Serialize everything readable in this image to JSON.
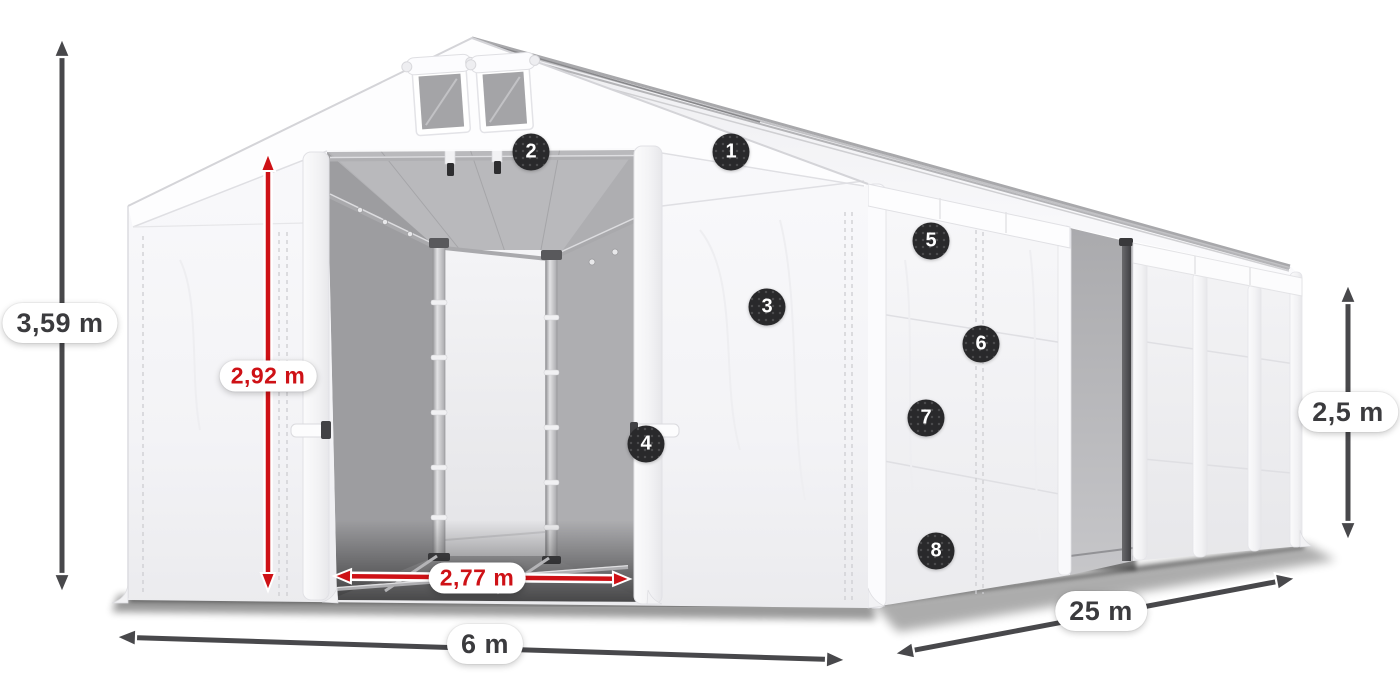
{
  "diagram": {
    "dimensions": {
      "total_height": "3,59 m",
      "door_height": "2,92 m",
      "door_width": "2,77 m",
      "width": "6 m",
      "length": "25 m",
      "side_wall_height": "2,5 m"
    },
    "feature_markers": [
      {
        "number": "1"
      },
      {
        "number": "2"
      },
      {
        "number": "3"
      },
      {
        "number": "4"
      },
      {
        "number": "5"
      },
      {
        "number": "6"
      },
      {
        "number": "7"
      },
      {
        "number": "8"
      }
    ],
    "colors": {
      "accent_red": "#ce1116",
      "arrow_dark": "#48484b",
      "badge_bg": "#29292b",
      "label_text_dark": "#3b3b3e",
      "background": "#ffffff"
    }
  }
}
